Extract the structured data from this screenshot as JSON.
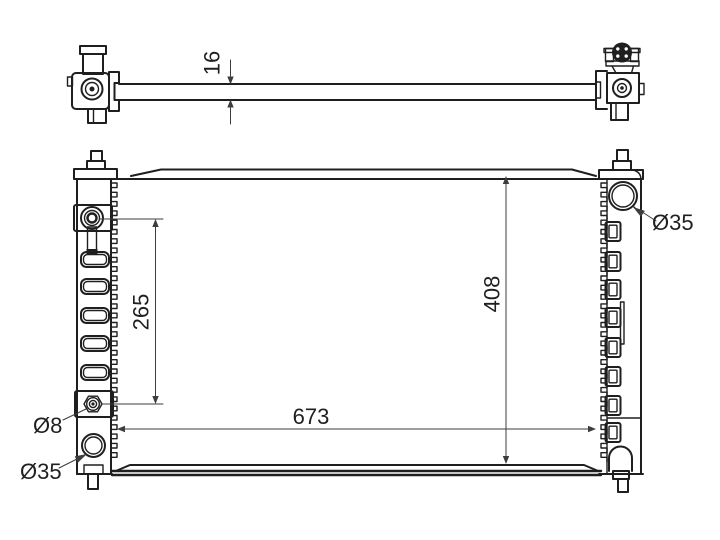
{
  "drawing": {
    "dimensions": {
      "core_thickness": "16",
      "port_spacing": "265",
      "core_height": "408",
      "core_width": "673",
      "oil_cooler_fitting": "Ø8",
      "outlet_pipe": "Ø35",
      "inlet_pipe": "Ø35"
    },
    "colors": {
      "background": "#ffffff",
      "outline": "#1f1f1f",
      "dimension": "#3d3d3d"
    }
  }
}
